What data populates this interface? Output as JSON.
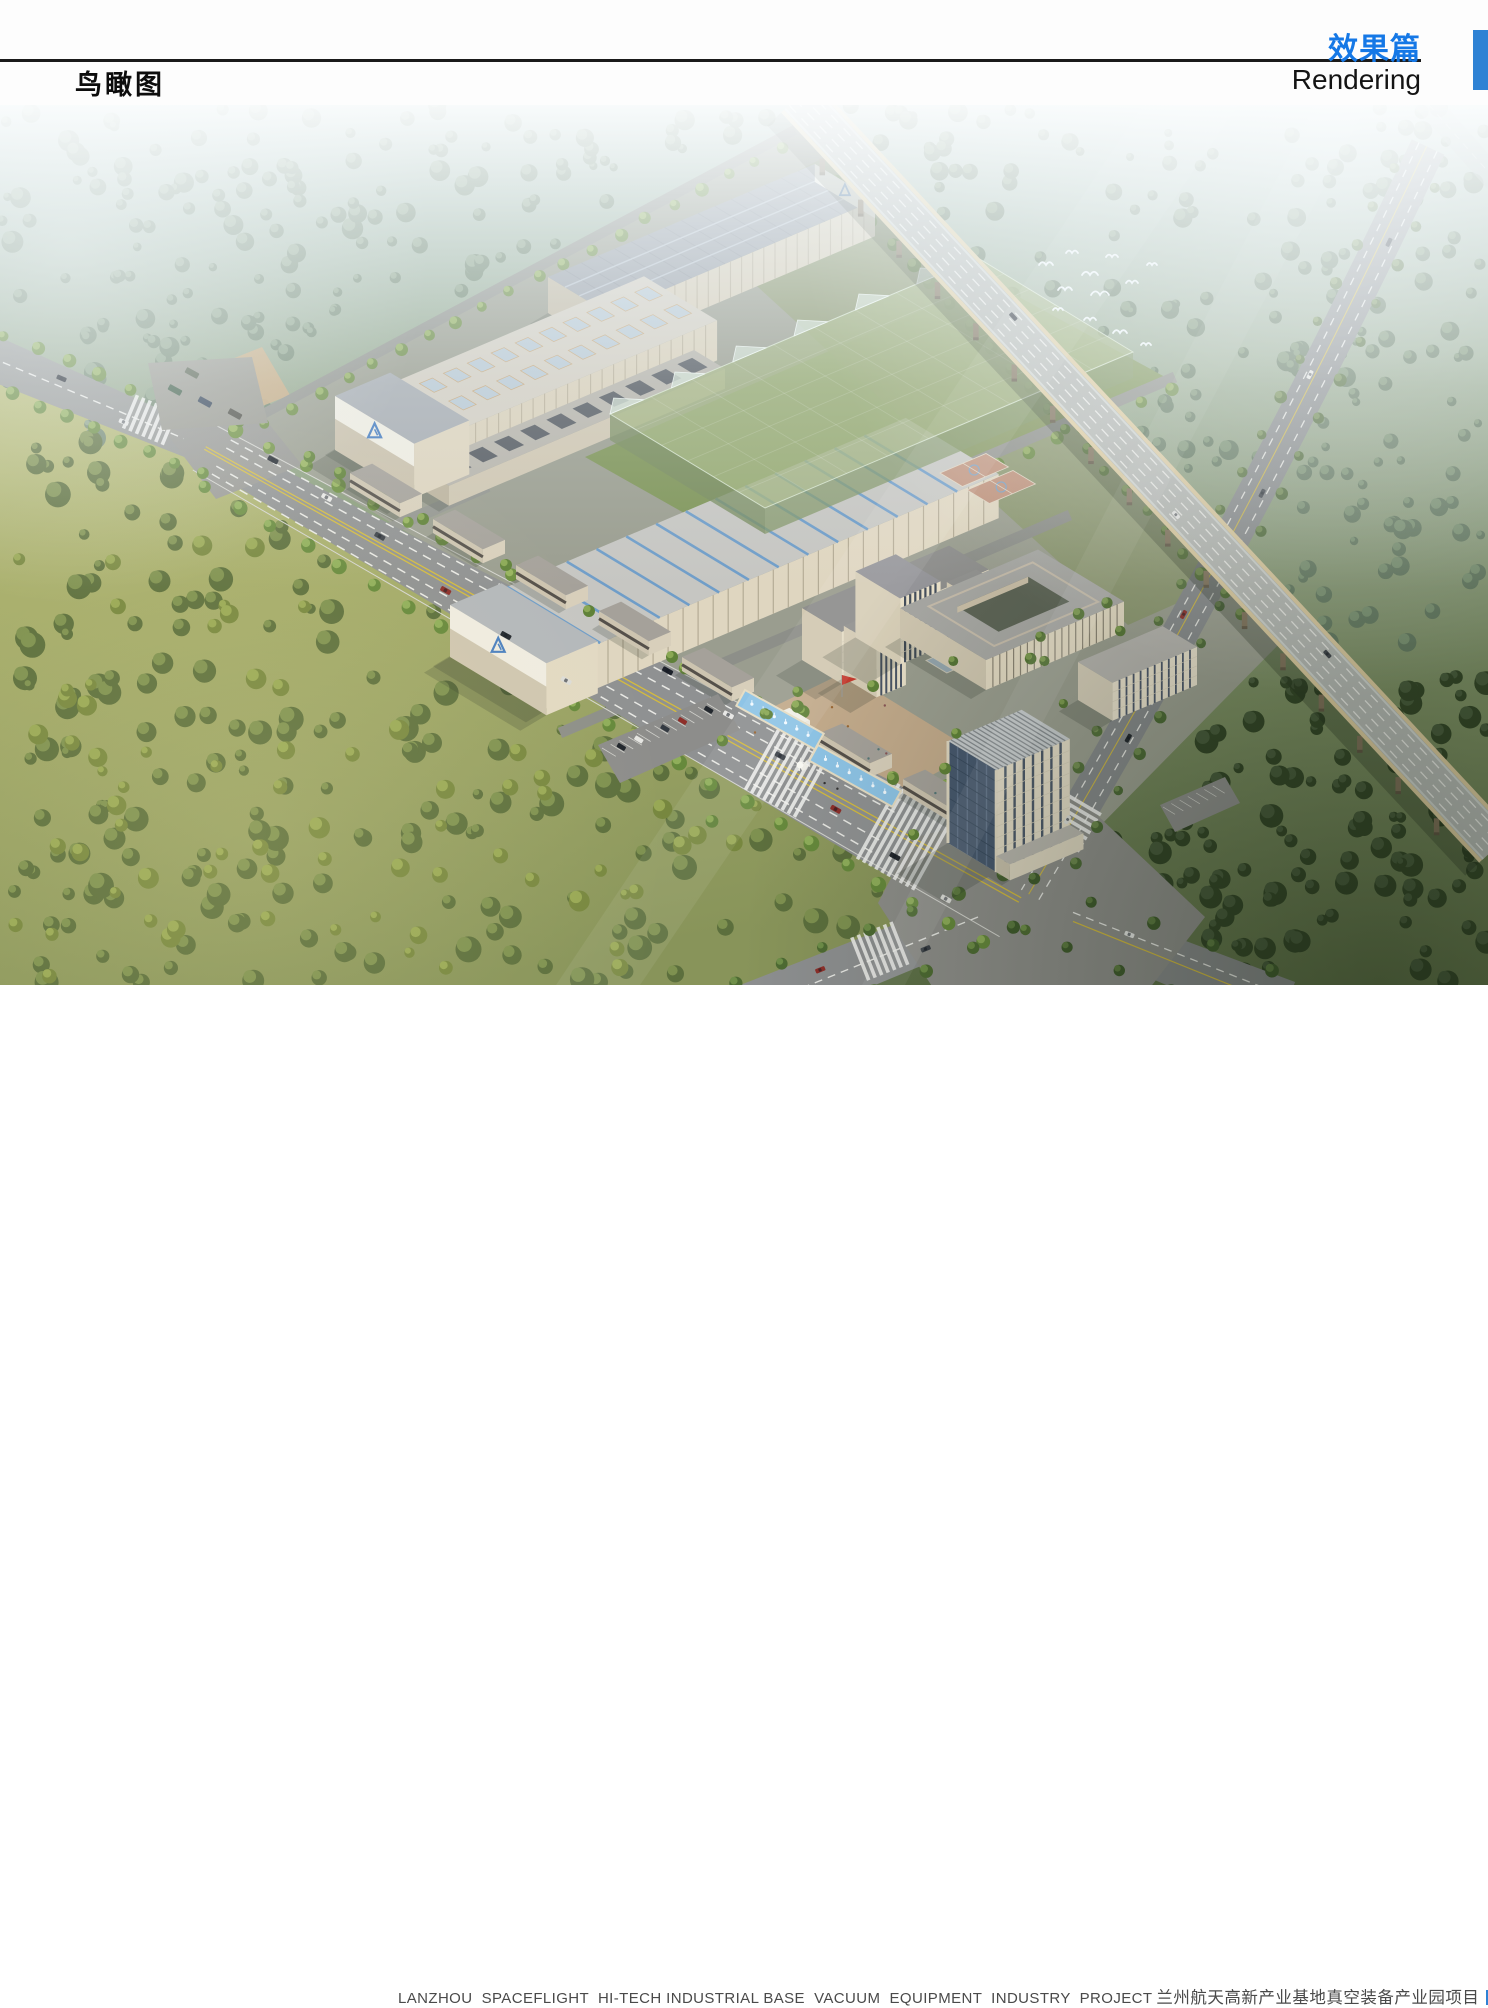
{
  "header": {
    "view_title": "鸟瞰图",
    "section_title_cn": "效果篇",
    "section_title_en": "Rendering"
  },
  "footer": {
    "project_name_en": "LANZHOU  SPACEFLIGHT  HI-TECH INDUSTRIAL BASE  VACUUM  EQUIPMENT  INDUSTRY  PROJECT",
    "project_name_cn": "兰州航天高新产业基地真空装备产业园项目"
  },
  "rendering": {
    "subject": "aerial bird's-eye rendering of industrial park with factory halls, office tower, plaza with fountains, elevated expressway, tree-lined avenues",
    "icons": [
      "bird-icon",
      "car-icon",
      "tree-icon",
      "flag-icon"
    ]
  },
  "colors": {
    "accent_blue": "#2e82d4",
    "title_blue": "#1578e6",
    "header_line": "#1b1b1b",
    "caption_gray": "#4a4a4a"
  }
}
